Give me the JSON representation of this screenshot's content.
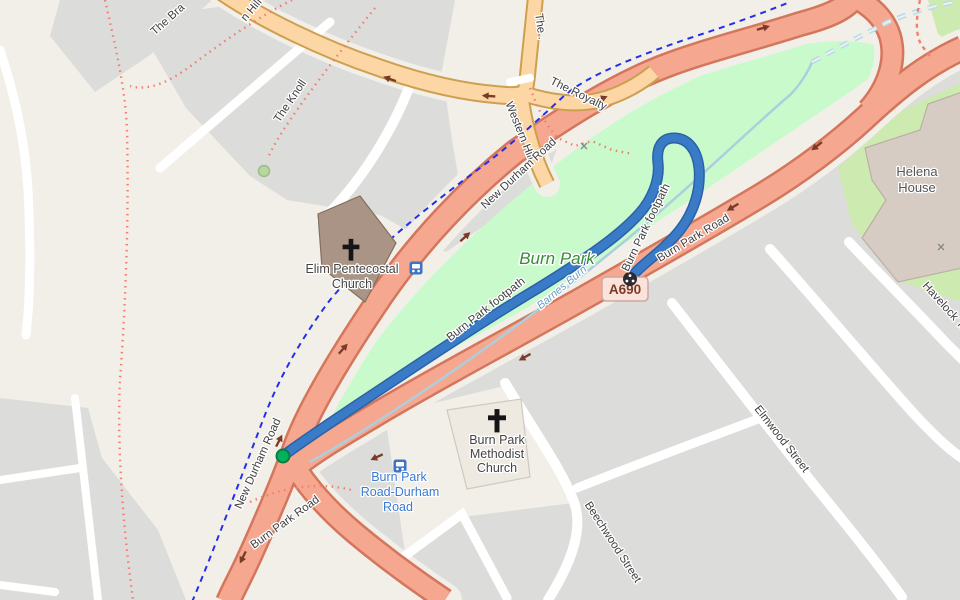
{
  "map": {
    "labels": {
      "the_brae": "The Bra",
      "western_hill_partial": "n Hill",
      "the_knoll": "The Knoll",
      "the_top": "The .",
      "the_royalty": "The Royalty",
      "western_hill": "Western Hill",
      "new_durham_road_upper": "New Durham Road",
      "new_durham_road_lower": "New Durham Road",
      "burn_park_road_upper": "Burn Park Road",
      "burn_park_road_lower": "Burn Park Road",
      "footpath_mid": "Burn Park footpath",
      "footpath_upper": "Burn Park footpath",
      "park_name": "Burn Park",
      "stream_name": "Barnes Burn",
      "elim_line1": "Elim Pentecostal",
      "elim_line2": "Church",
      "methodist_line1": "Burn Park",
      "methodist_line2": "Methodist",
      "methodist_line3": "Church",
      "helena_line1": "Helena",
      "helena_line2": "House",
      "havelock": "Havelock Terrace",
      "elmwood": "Elmwood Street",
      "beechwood": "Beechwood Street",
      "busstop_line1": "Burn Park",
      "busstop_line2": "Road-Durham",
      "busstop_line3": "Road",
      "road_ref": "A690"
    },
    "colors": {
      "background": "#f2efe9",
      "residential_block": "#dcdcda",
      "park_green": "#c8facc",
      "grass_green": "#cdebb0",
      "trunk_road": "#f5a78f",
      "trunk_casing": "#d4765c",
      "primary_road": "#fcd6a4",
      "primary_casing": "#cda04f",
      "route_blue": "#3a7bc8",
      "cycle_route_blue": "#2430e8",
      "footpath_red": "#f08070",
      "stream_blue": "#accfdd",
      "start_marker_green": "#00b25a",
      "end_marker_dark": "#2b2b33",
      "bus_icon_blue": "#3d75c4",
      "shield_bg": "#fbe3d9"
    }
  }
}
